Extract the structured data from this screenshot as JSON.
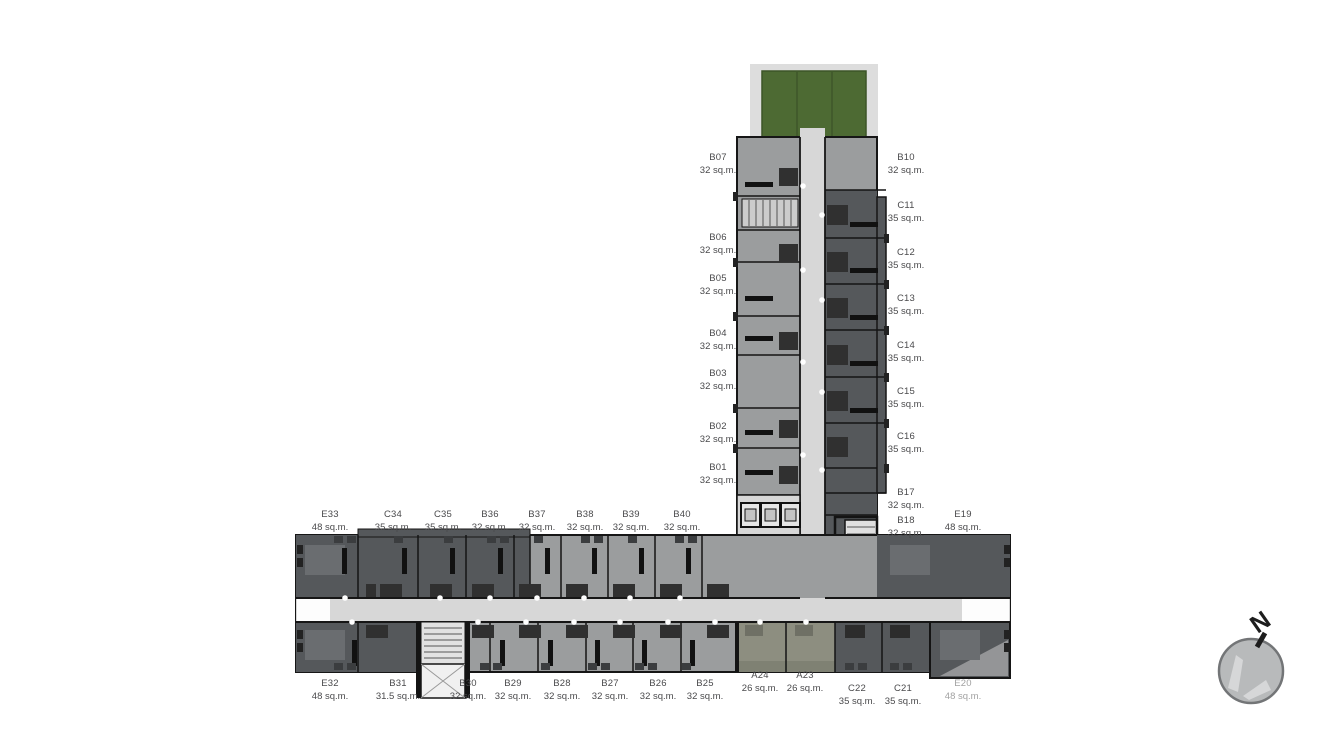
{
  "plan": {
    "compass_label": "N",
    "core": {
      "lift_hall": "LIFT HALL",
      "fireman_line1": "FIREMAN",
      "fireman_line2": "LIFT"
    }
  },
  "colors": {
    "c-green": "#4d6a33",
    "c-green-border": "#3c5527",
    "c-dark": "#55585b",
    "c-med": "#9b9d9e",
    "c-corr": "#d7d7d7",
    "c-olive": "#8d8e80",
    "c-wall": "#161616",
    "c-label": "#4a4a4c",
    "c-muted": "#a2a2a2"
  },
  "units": [
    {
      "id": "B07",
      "area": "32 sq.m.",
      "x": 718,
      "y": 164
    },
    {
      "id": "B06",
      "area": "32 sq.m.",
      "x": 718,
      "y": 244
    },
    {
      "id": "B05",
      "area": "32 sq.m.",
      "x": 718,
      "y": 285
    },
    {
      "id": "B04",
      "area": "32 sq.m.",
      "x": 718,
      "y": 340
    },
    {
      "id": "B03",
      "area": "32 sq.m.",
      "x": 718,
      "y": 380
    },
    {
      "id": "B02",
      "area": "32 sq.m.",
      "x": 718,
      "y": 433
    },
    {
      "id": "B01",
      "area": "32 sq.m.",
      "x": 718,
      "y": 474
    },
    {
      "id": "B10",
      "area": "32 sq.m.",
      "x": 906,
      "y": 164
    },
    {
      "id": "C11",
      "area": "35 sq.m.",
      "x": 906,
      "y": 212
    },
    {
      "id": "C12",
      "area": "35 sq.m.",
      "x": 906,
      "y": 259
    },
    {
      "id": "C13",
      "area": "35 sq.m.",
      "x": 906,
      "y": 305
    },
    {
      "id": "C14",
      "area": "35 sq.m.",
      "x": 906,
      "y": 352
    },
    {
      "id": "C15",
      "area": "35 sq.m.",
      "x": 906,
      "y": 398
    },
    {
      "id": "C16",
      "area": "35 sq.m.",
      "x": 906,
      "y": 443
    },
    {
      "id": "B17",
      "area": "32 sq.m.",
      "x": 906,
      "y": 499
    },
    {
      "id": "B18",
      "area": "32 sq.m.",
      "x": 906,
      "y": 527
    },
    {
      "id": "E19",
      "area": "48 sq.m.",
      "x": 963,
      "y": 521
    },
    {
      "id": "E33",
      "area": "48 sq.m.",
      "x": 330,
      "y": 521
    },
    {
      "id": "C34",
      "area": "35 sq.m.",
      "x": 393,
      "y": 521
    },
    {
      "id": "C35",
      "area": "35 sq.m.",
      "x": 443,
      "y": 521
    },
    {
      "id": "B36",
      "area": "32 sq.m.",
      "x": 490,
      "y": 521
    },
    {
      "id": "B37",
      "area": "32 sq.m.",
      "x": 537,
      "y": 521
    },
    {
      "id": "B38",
      "area": "32 sq.m.",
      "x": 585,
      "y": 521
    },
    {
      "id": "B39",
      "area": "32 sq.m.",
      "x": 631,
      "y": 521
    },
    {
      "id": "B40",
      "area": "32 sq.m.",
      "x": 682,
      "y": 521
    },
    {
      "id": "E32",
      "area": "48 sq.m.",
      "x": 330,
      "y": 690
    },
    {
      "id": "B31",
      "area": "31.5 sq.m.",
      "x": 398,
      "y": 690
    },
    {
      "id": "B30",
      "area": "32 sq.m.",
      "x": 468,
      "y": 690
    },
    {
      "id": "B29",
      "area": "32 sq.m.",
      "x": 513,
      "y": 690
    },
    {
      "id": "B28",
      "area": "32 sq.m.",
      "x": 562,
      "y": 690
    },
    {
      "id": "B27",
      "area": "32 sq.m.",
      "x": 610,
      "y": 690
    },
    {
      "id": "B26",
      "area": "32 sq.m.",
      "x": 658,
      "y": 690
    },
    {
      "id": "B25",
      "area": "32 sq.m.",
      "x": 705,
      "y": 690
    },
    {
      "id": "A24",
      "area": "26 sq.m.",
      "x": 760,
      "y": 682
    },
    {
      "id": "A23",
      "area": "26 sq.m.",
      "x": 805,
      "y": 682
    },
    {
      "id": "C22",
      "area": "35 sq.m.",
      "x": 857,
      "y": 695
    },
    {
      "id": "C21",
      "area": "35 sq.m.",
      "x": 903,
      "y": 695
    },
    {
      "id": "E20",
      "area": "48 sq.m.",
      "x": 963,
      "y": 690,
      "muted": true
    }
  ]
}
